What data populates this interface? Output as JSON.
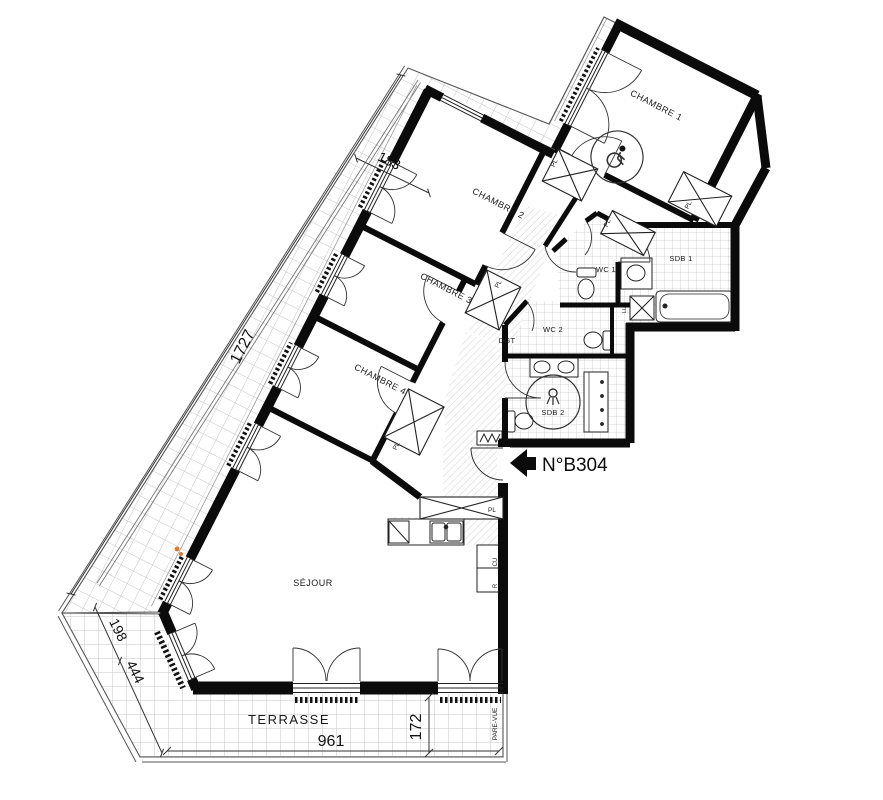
{
  "unit": {
    "number": "N°B304"
  },
  "rooms": {
    "chambre1": "CHAMBRE 1",
    "chambre2": "CHAMBRE 2",
    "chambre3": "CHAMBRE 3",
    "chambre4": "CHAMBRE 4",
    "sejour": "SÉJOUR",
    "terrasse": "TERRASSE",
    "sdb1": "SDB 1",
    "sdb2": "SDB 2",
    "wc1": "WC 1",
    "wc2": "WC 2",
    "dgt": "DGT"
  },
  "dimensions": {
    "facade_total": "1727",
    "facade_top": "183",
    "left_a": "198",
    "left_b": "444",
    "terrace_width": "961",
    "terrace_depth": "172"
  },
  "annotations": {
    "closet": "PL",
    "kitchen_unit": "CU",
    "fridge": "R",
    "washer": "LL",
    "screen": "PARE-VUE"
  },
  "colors": {
    "wall": "#0b0b0b",
    "tile_line": "#c6c6c6",
    "hatch_line": "#d9d9d9",
    "accent_mark": "#e07b2a"
  }
}
